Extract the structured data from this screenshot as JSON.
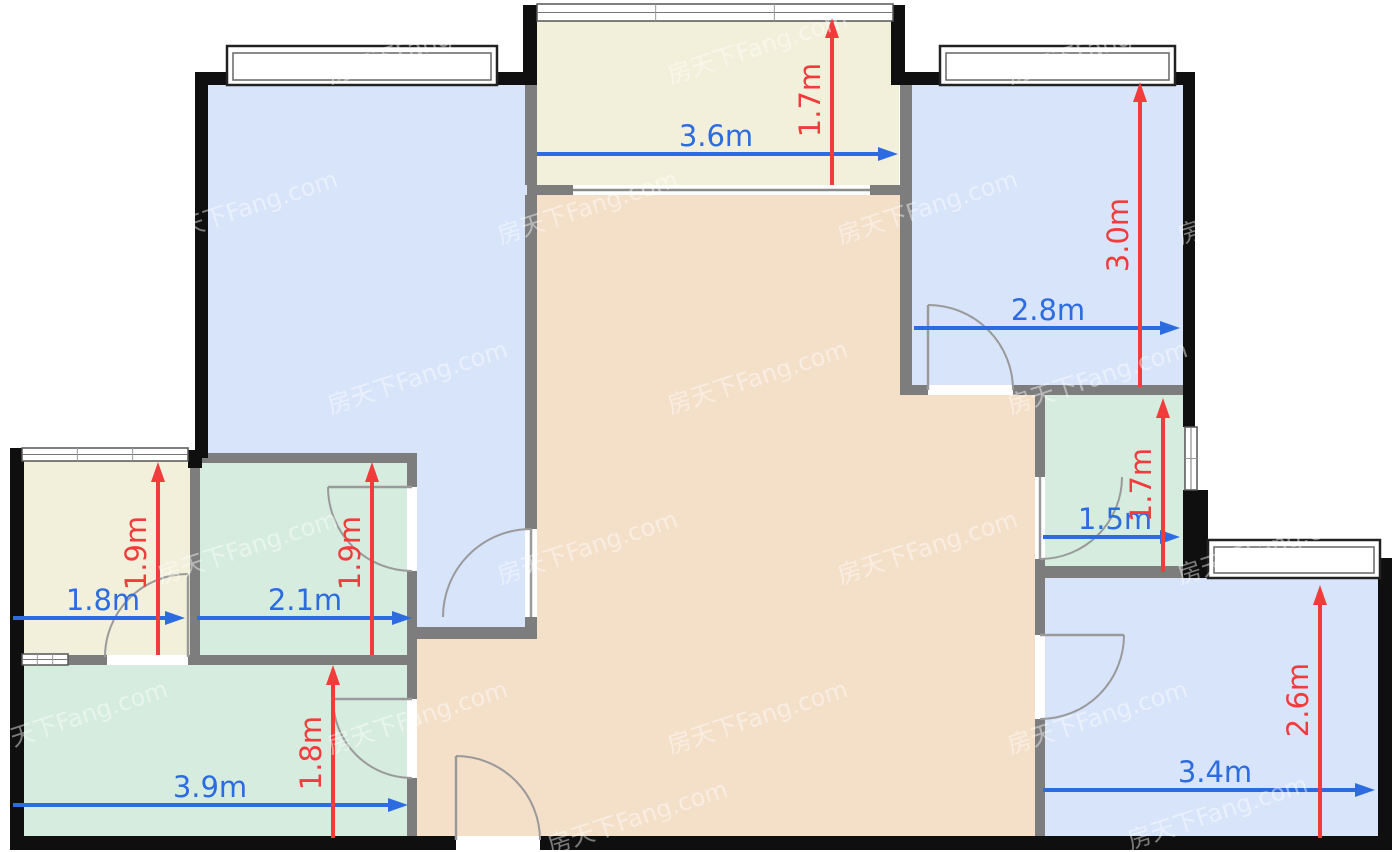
{
  "canvas": {
    "width": 1400,
    "height": 852,
    "background": "#ffffff"
  },
  "palette": {
    "wall_exterior": "#0f0f0f",
    "wall_interior": "#7d7d7d",
    "room_blue": "#d7e4fa",
    "room_cream": "#f2f0da",
    "room_peach": "#f4dfc9",
    "room_teal": "#d5ecdf",
    "dim_blue": "#2d6ce0",
    "dim_red": "#f23c3c",
    "door_stroke": "#9a9a9a",
    "window_frame_dark": "#222222",
    "window_frame_light": "#666666",
    "watermark": "#ffffff"
  },
  "watermark": {
    "text": "房天下Fang.com",
    "angle": -18,
    "opacity": 0.45,
    "font_size": 24,
    "positions": [
      [
        420,
        55
      ],
      [
        760,
        55
      ],
      [
        1100,
        55
      ],
      [
        250,
        215
      ],
      [
        590,
        215
      ],
      [
        930,
        215
      ],
      [
        1270,
        215
      ],
      [
        80,
        385
      ],
      [
        420,
        385
      ],
      [
        760,
        385
      ],
      [
        1100,
        385
      ],
      [
        250,
        555
      ],
      [
        590,
        555
      ],
      [
        930,
        555
      ],
      [
        1270,
        555
      ],
      [
        80,
        725
      ],
      [
        420,
        725
      ],
      [
        760,
        725
      ],
      [
        1100,
        725
      ],
      [
        640,
        825
      ],
      [
        1220,
        820
      ]
    ]
  },
  "rooms": [
    {
      "name": "bedroom-top-left",
      "fill": "room_blue",
      "points": [
        [
          202,
          80
        ],
        [
          531,
          80
        ],
        [
          531,
          633
        ],
        [
          412,
          633
        ],
        [
          412,
          458
        ],
        [
          202,
          458
        ]
      ]
    },
    {
      "name": "balcony-top",
      "fill": "room_cream",
      "points": [
        [
          531,
          12
        ],
        [
          899,
          12
        ],
        [
          899,
          190
        ],
        [
          531,
          190
        ]
      ]
    },
    {
      "name": "bedroom-top-right",
      "fill": "room_blue",
      "points": [
        [
          906,
          80
        ],
        [
          1189,
          80
        ],
        [
          1189,
          390
        ],
        [
          906,
          390
        ]
      ]
    },
    {
      "name": "living-dining",
      "fill": "room_peach",
      "points": [
        [
          537,
          190
        ],
        [
          906,
          190
        ],
        [
          906,
          390
        ],
        [
          1040,
          390
        ],
        [
          1040,
          842
        ],
        [
          417,
          842
        ],
        [
          417,
          633
        ],
        [
          537,
          633
        ]
      ]
    },
    {
      "name": "bathroom-right",
      "fill": "room_teal",
      "points": [
        [
          1040,
          390
        ],
        [
          1189,
          390
        ],
        [
          1189,
          570
        ],
        [
          1040,
          570
        ]
      ]
    },
    {
      "name": "bedroom-bottom-right",
      "fill": "room_blue",
      "points": [
        [
          1040,
          578
        ],
        [
          1384,
          578
        ],
        [
          1384,
          842
        ],
        [
          1040,
          842
        ]
      ]
    },
    {
      "name": "balcony-left",
      "fill": "room_cream",
      "points": [
        [
          16,
          455
        ],
        [
          195,
          455
        ],
        [
          195,
          660
        ],
        [
          16,
          660
        ]
      ]
    },
    {
      "name": "bathroom-left",
      "fill": "room_teal",
      "points": [
        [
          195,
          458
        ],
        [
          412,
          458
        ],
        [
          412,
          660
        ],
        [
          195,
          660
        ]
      ]
    },
    {
      "name": "kitchen",
      "fill": "room_teal",
      "points": [
        [
          16,
          660
        ],
        [
          412,
          660
        ],
        [
          412,
          842
        ],
        [
          16,
          842
        ]
      ]
    }
  ],
  "walls": {
    "exterior": [
      [
        195,
        72,
        342,
        13
      ],
      [
        195,
        72,
        13,
        386
      ],
      [
        523,
        5,
        14,
        80
      ],
      [
        891,
        5,
        14,
        80
      ],
      [
        905,
        72,
        290,
        13
      ],
      [
        1183,
        72,
        12,
        355
      ],
      [
        1183,
        490,
        25,
        88
      ],
      [
        1378,
        558,
        14,
        292
      ],
      [
        10,
        448,
        14,
        402
      ],
      [
        188,
        450,
        14,
        18
      ],
      [
        10,
        836,
        446,
        14
      ],
      [
        540,
        836,
        850,
        14
      ]
    ],
    "interior": [
      [
        525,
        85,
        12,
        100
      ],
      [
        527,
        185,
        383,
        10
      ],
      [
        900,
        85,
        12,
        100
      ],
      [
        900,
        185,
        12,
        200
      ],
      [
        525,
        195,
        12,
        334
      ],
      [
        525,
        617,
        12,
        22
      ],
      [
        417,
        627,
        120,
        12
      ],
      [
        190,
        466,
        10,
        192
      ],
      [
        192,
        453,
        225,
        10
      ],
      [
        407,
        453,
        10,
        34
      ],
      [
        407,
        571,
        10,
        94
      ],
      [
        68,
        655,
        39,
        10
      ],
      [
        188,
        655,
        229,
        10
      ],
      [
        407,
        665,
        10,
        34
      ],
      [
        407,
        778,
        10,
        58
      ],
      [
        900,
        385,
        28,
        10
      ],
      [
        1013,
        385,
        182,
        10
      ],
      [
        1035,
        395,
        10,
        82
      ],
      [
        1035,
        559,
        10,
        19
      ],
      [
        1035,
        566,
        180,
        12
      ],
      [
        1035,
        578,
        10,
        57
      ],
      [
        1035,
        719,
        10,
        117
      ]
    ]
  },
  "slider": {
    "rect": [
      573,
      185,
      297,
      10
    ],
    "line_y": 190
  },
  "windows": [
    {
      "name": "window-bedroom-top-left",
      "type": "bump",
      "rect": [
        227,
        46,
        270,
        39
      ]
    },
    {
      "name": "window-bedroom-top-right",
      "type": "bump",
      "rect": [
        940,
        46,
        235,
        39
      ]
    },
    {
      "name": "window-bedroom-bottom-right",
      "type": "bump",
      "rect": [
        1208,
        540,
        172,
        38
      ]
    },
    {
      "name": "window-balcony-top",
      "type": "flush-h",
      "rect": [
        537,
        4,
        356,
        17
      ]
    },
    {
      "name": "window-balcony-left",
      "type": "flush-h",
      "rect": [
        22,
        448,
        166,
        13
      ]
    },
    {
      "name": "window-bathroom-right",
      "type": "flush-v",
      "rect": [
        1185,
        427,
        12,
        63
      ]
    },
    {
      "name": "window-kitchen",
      "type": "flush-h",
      "rect": [
        22,
        654,
        46,
        11
      ]
    }
  ],
  "doors": [
    {
      "name": "door-bedroom-top-right",
      "gap": [
        928,
        385,
        85,
        10
      ],
      "leaf": [
        928,
        390,
        928,
        305
      ],
      "arc": "M 928 305 A 85 85 0 0 1 1013 390"
    },
    {
      "name": "door-bedroom-top-left",
      "gap": [
        525,
        529,
        12,
        88
      ],
      "leaf": [
        531,
        529,
        531,
        617
      ],
      "arc": "M 531 529 A 88 88 0 0 0 443 617"
    },
    {
      "name": "door-bathroom-left",
      "gap": [
        407,
        487,
        10,
        84
      ],
      "leaf": [
        412,
        487,
        328,
        487
      ],
      "arc": "M 328 487 A 84 84 0 0 0 412 571"
    },
    {
      "name": "door-balcony-left",
      "gap": [
        107,
        655,
        81,
        10
      ],
      "leaf": [
        188,
        574,
        188,
        657
      ],
      "arc": "M 188 574 A 83 83 0 0 0 105 657"
    },
    {
      "name": "door-kitchen",
      "gap": [
        407,
        699,
        10,
        79
      ],
      "leaf": [
        412,
        699,
        333,
        699
      ],
      "arc": "M 333 699 A 79 79 0 0 0 412 778"
    },
    {
      "name": "door-entrance",
      "gap": [
        456,
        836,
        84,
        14
      ],
      "leaf": [
        456,
        756,
        456,
        840
      ],
      "arc": "M 456 756 A 84 84 0 0 1 540 840"
    },
    {
      "name": "door-bathroom-right",
      "gap": [
        1035,
        477,
        10,
        82
      ],
      "leaf": [
        1040,
        477,
        1040,
        559
      ],
      "arc": "M 1122 477 A 82 82 0 0 1 1040 559"
    },
    {
      "name": "door-bedroom-bottom-right",
      "gap": [
        1035,
        635,
        10,
        84
      ],
      "leaf": [
        1040,
        635,
        1124,
        635
      ],
      "arc": "M 1124 635 A 84 84 0 0 1 1040 719"
    }
  ],
  "dimensions": [
    {
      "name": "dim-balcony-top-width",
      "value": "3.6m",
      "axis": "h",
      "color": "dim_blue",
      "line": [
        537,
        154,
        898,
        154
      ],
      "label": [
        716,
        146
      ]
    },
    {
      "name": "dim-balcony-top-depth",
      "value": "1.7m",
      "axis": "v",
      "color": "dim_red",
      "line": [
        832,
        185,
        832,
        18
      ],
      "label": [
        820,
        100
      ]
    },
    {
      "name": "dim-bedroom-top-right-width",
      "value": "2.8m",
      "axis": "h",
      "color": "dim_blue",
      "line": [
        914,
        328,
        1180,
        328
      ],
      "label": [
        1048,
        320
      ]
    },
    {
      "name": "dim-bedroom-top-right-depth",
      "value": "3.0m",
      "axis": "v",
      "color": "dim_red",
      "line": [
        1140,
        387,
        1140,
        82
      ],
      "label": [
        1128,
        235
      ]
    },
    {
      "name": "dim-bathroom-right-width",
      "value": "1.5m",
      "axis": "h",
      "color": "dim_blue",
      "line": [
        1043,
        537,
        1180,
        537
      ],
      "label": [
        1115,
        529
      ]
    },
    {
      "name": "dim-bathroom-right-depth",
      "value": "1.7m",
      "axis": "v",
      "color": "dim_red",
      "line": [
        1163,
        572,
        1163,
        398
      ],
      "label": [
        1151,
        485
      ]
    },
    {
      "name": "dim-bedroom-bottom-right-width",
      "value": "3.4m",
      "axis": "h",
      "color": "dim_blue",
      "line": [
        1043,
        790,
        1375,
        790
      ],
      "label": [
        1215,
        782
      ]
    },
    {
      "name": "dim-bedroom-bottom-right-depth",
      "value": "2.6m",
      "axis": "v",
      "color": "dim_red",
      "line": [
        1320,
        838,
        1320,
        585
      ],
      "label": [
        1308,
        700
      ]
    },
    {
      "name": "dim-balcony-left-width",
      "value": "1.8m",
      "axis": "h",
      "color": "dim_blue",
      "line": [
        13,
        618,
        185,
        618
      ],
      "label": [
        103,
        610
      ]
    },
    {
      "name": "dim-balcony-left-depth",
      "value": "1.9m",
      "axis": "v",
      "color": "dim_red",
      "line": [
        158,
        655,
        158,
        462
      ],
      "label": [
        146,
        553
      ]
    },
    {
      "name": "dim-bathroom-left-width",
      "value": "2.1m",
      "axis": "h",
      "color": "dim_blue",
      "line": [
        197,
        618,
        412,
        618
      ],
      "label": [
        305,
        610
      ]
    },
    {
      "name": "dim-bathroom-left-depth",
      "value": "1.9m",
      "axis": "v",
      "color": "dim_red",
      "line": [
        372,
        655,
        372,
        462
      ],
      "label": [
        360,
        553
      ]
    },
    {
      "name": "dim-kitchen-width",
      "value": "3.9m",
      "axis": "h",
      "color": "dim_blue",
      "line": [
        13,
        805,
        408,
        805
      ],
      "label": [
        210,
        797
      ]
    },
    {
      "name": "dim-kitchen-depth",
      "value": "1.8m",
      "axis": "v",
      "color": "dim_red",
      "line": [
        333,
        838,
        333,
        665
      ],
      "label": [
        321,
        753
      ]
    }
  ],
  "dim_font_size": 29
}
